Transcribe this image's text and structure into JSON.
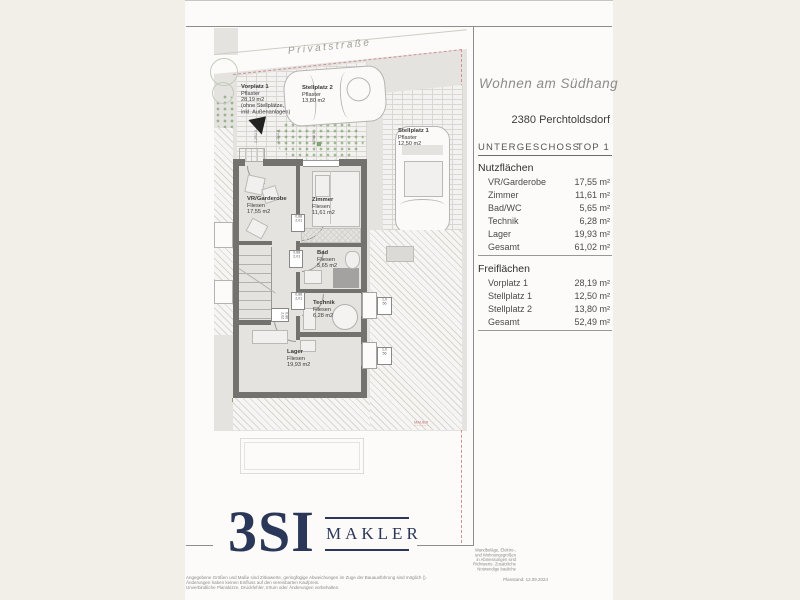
{
  "header": {
    "project": "Wohnen am Südhang",
    "location": "2380 Perchtoldsdorf",
    "floor": "UNTERGESCHOSS",
    "unit": "TOP 1"
  },
  "area_table": {
    "sections": [
      {
        "title": "Nutzflächen",
        "rows": [
          {
            "label": "VR/Garderobe",
            "value": "17,55 m²"
          },
          {
            "label": "Zimmer",
            "value": "11,61 m²"
          },
          {
            "label": "Bad/WC",
            "value": "5,65 m²"
          },
          {
            "label": "Technik",
            "value": "6,28 m²"
          },
          {
            "label": "Lager",
            "value": "19,93 m²"
          },
          {
            "label": "Gesamt",
            "value": "61,02 m²"
          }
        ]
      },
      {
        "title": "Freiflächen",
        "rows": [
          {
            "label": "Vorplatz 1",
            "value": "28,19 m²"
          },
          {
            "label": "Stellplatz 1",
            "value": "12,50 m²"
          },
          {
            "label": "Stellplatz 2",
            "value": "13,80 m²"
          },
          {
            "label": "Gesamt",
            "value": "52,49 m²"
          }
        ]
      }
    ]
  },
  "plan": {
    "street": "Privatstraße",
    "outdoor": [
      {
        "name": "Vorplatz 1",
        "surface": "Pflaster",
        "area": "28,19 m2",
        "note1": "(ohne Stellplätze,",
        "note2": "inkl. Außenanlagen)"
      },
      {
        "name": "Stellplatz 2",
        "surface": "Pflaster",
        "area": "13,80 m2"
      },
      {
        "name": "Stellplatz 1",
        "surface": "Pflaster",
        "area": "12,50 m2"
      }
    ],
    "rooms": [
      {
        "name": "VR/Garderobe",
        "surface": "Fliesen",
        "area": "17,55 m2"
      },
      {
        "name": "Zimmer",
        "surface": "Fliesen",
        "area": "11,61 m2"
      },
      {
        "name": "Bad",
        "surface": "Fliesen",
        "area": "5,65 m2"
      },
      {
        "name": "Technik",
        "surface": "Fliesen",
        "area": "6,28 m2"
      },
      {
        "name": "Lager",
        "surface": "Fliesen",
        "area": "19,93 m2"
      }
    ],
    "tags": {
      "door_w": "0,88",
      "door_h": "2,01",
      "stair_w": "0,80",
      "stair_h": "2,02",
      "window_w": "1,0",
      "window_h": "56",
      "top_tag": "1,25/2,5"
    },
    "wall_note": "MAUER"
  },
  "footer": {
    "logo": "3SI",
    "logo_sub": "MAKLER",
    "disclaimer_left": [
      "Angegebene Größen und Maße sind Zirkawerte, geringfügige Abweichungen im Zuge der Bauausführung sind möglich ().",
      "Änderungen haben keinen Einfluss auf den vereinbarten Kaufpreis.",
      "Unverbindliche Planskizze, Druckfehler, Irrtum oder Änderungen vorbehalten."
    ],
    "disclaimer_right": [
      "Wandbeläge, Elektro-,",
      "und Wohnungsgrößen",
      "in Abmessungen sind",
      "Richtwerte. Zusätzliche",
      "Notwendige bauliche"
    ],
    "plan_date": "Planstand: 12.09.2024"
  },
  "colors": {
    "navy": "#2b3758",
    "boundary_red": "#c98f8e",
    "wall_gray": "#73726f",
    "site_gray": "#e4e3e0",
    "page_beige": "#f2efe9"
  }
}
